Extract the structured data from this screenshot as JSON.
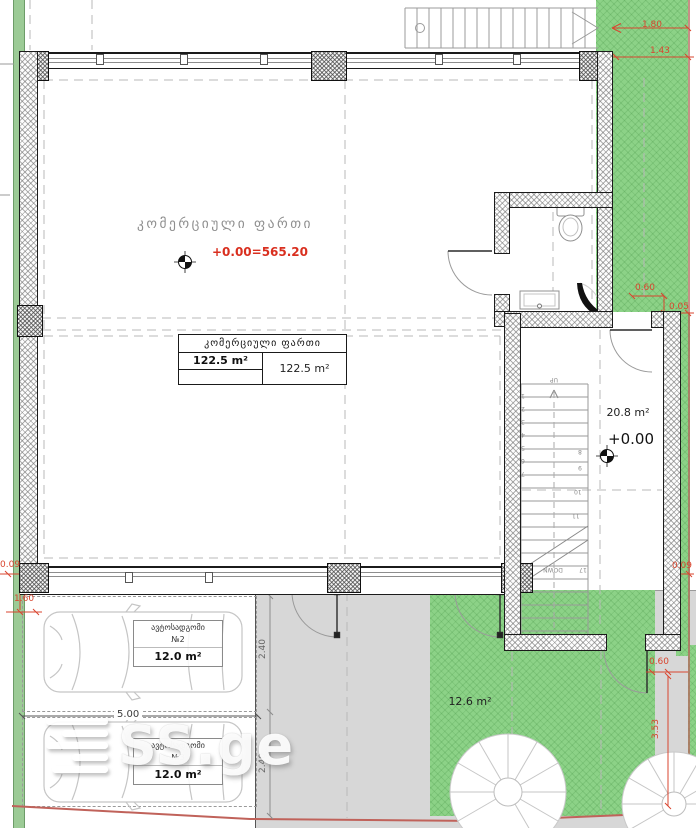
{
  "plan": {
    "commercial_room": {
      "name": "კომერციული ფართი",
      "elevation": "+0.00=565.20"
    },
    "area_table": {
      "header": "კომერციული ფართი",
      "left_area": "122.5 m²",
      "right_area": "122.5 m²"
    },
    "stairwell": {
      "area": "20.8 m²",
      "elevation": "+0.00",
      "up_label": "UP",
      "down_label": "DOWN",
      "step_total": "17",
      "steps_left": [
        "1",
        "2",
        "3",
        "4",
        "5",
        "6",
        "7"
      ],
      "steps_right": [
        "8",
        "9",
        "10",
        "11"
      ]
    },
    "parking": {
      "stall_1": {
        "title": "ავტოსადგომი",
        "number": "№2",
        "area": "12.0 m²"
      },
      "stall_2": {
        "title": "ავტოსადგომი",
        "number": "№3",
        "area": "12.0 m²"
      }
    },
    "landscaping": {
      "lawn_area": "12.6 m²"
    },
    "dimensions": {
      "top_offset": "1.80",
      "top_setback": "1.43",
      "right_upper_a": "0.60",
      "right_upper_b": "0.05",
      "right_mid": "0.09",
      "right_lower_a": "0.60",
      "right_lower_b": "3.53",
      "left_a": "0.09",
      "left_b": "1.60",
      "stall_width": "5.00",
      "stall_depth_1": "2.40",
      "stall_depth_2": "2.40"
    },
    "watermark": "SS.ge",
    "colors": {
      "lawn": "#8cd287",
      "paving": "#d7d7d7",
      "dimension_red": "#d9452f",
      "elevation_red": "#d92f1f",
      "boundary": "#c0625a"
    }
  }
}
